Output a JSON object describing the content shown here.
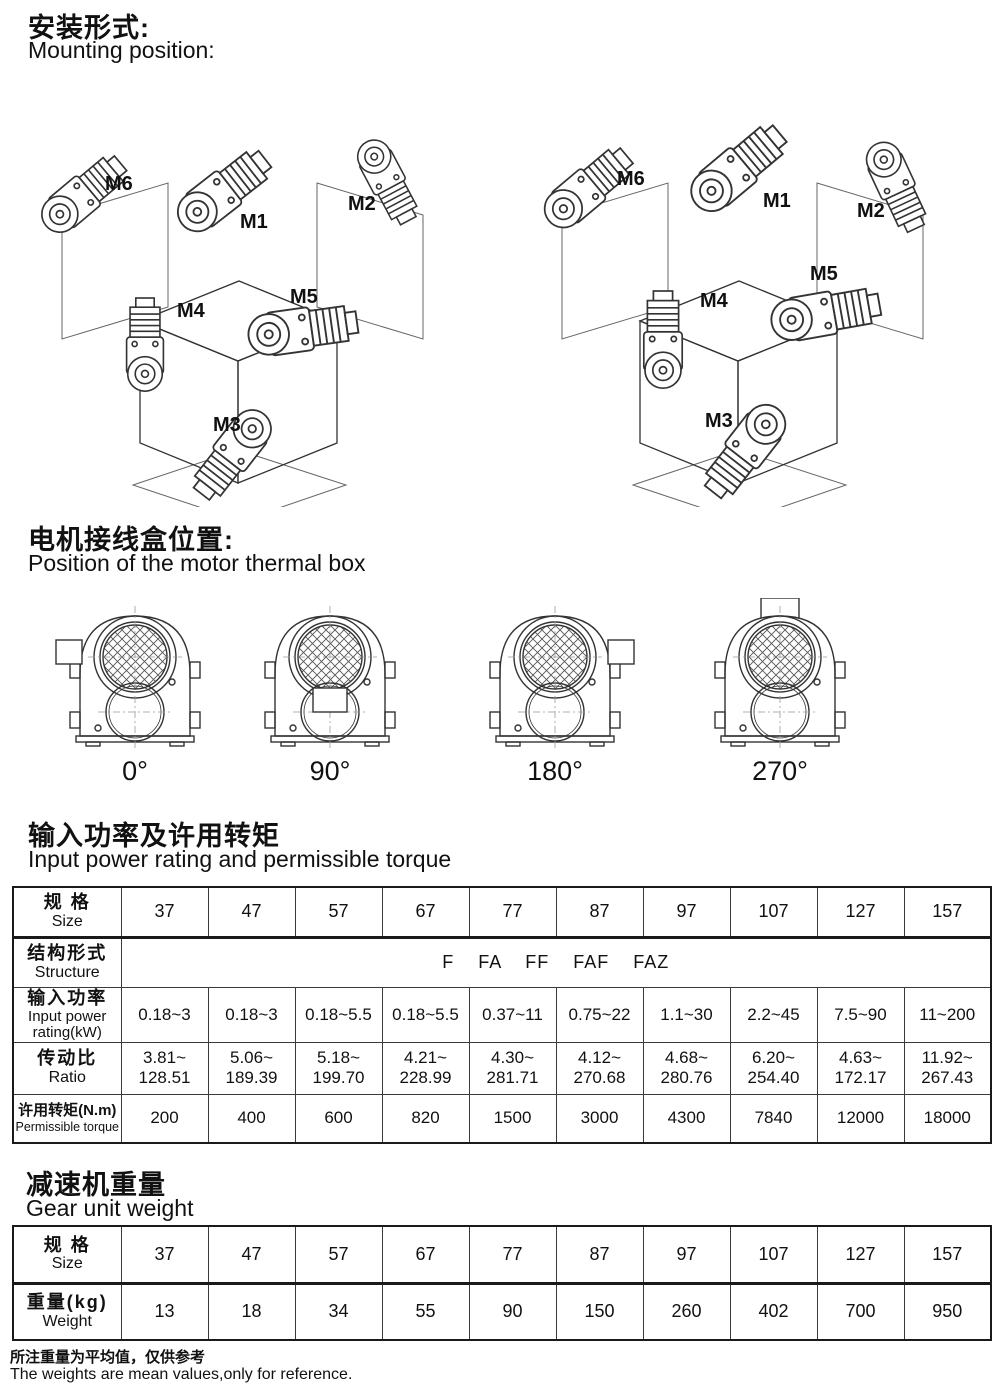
{
  "mounting": {
    "title_zh": "安装形式:",
    "title_en": "Mounting position:",
    "labels": {
      "m1": "M1",
      "m2": "M2",
      "m3": "M3",
      "m4": "M4",
      "m5": "M5",
      "m6": "M6"
    }
  },
  "thermal": {
    "title_zh": "电机接线盒位置:",
    "title_en": "Position of the motor thermal box",
    "angles": [
      "0°",
      "90°",
      "180°",
      "270°"
    ]
  },
  "power_table": {
    "title_zh": "输入功率及许用转矩",
    "title_en": "Input power rating and permissible torque",
    "head": {
      "zh": "规 格",
      "en": "Size"
    },
    "sizes": [
      "37",
      "47",
      "57",
      "67",
      "77",
      "87",
      "97",
      "107",
      "127",
      "157"
    ],
    "structure": {
      "zh": "结构形式",
      "en": "Structure",
      "value": "F    FA    FF    FAF    FAZ"
    },
    "power": {
      "zh": "输入功率",
      "en": "Input power",
      "en2": "rating(kW)",
      "values": [
        "0.18~3",
        "0.18~3",
        "0.18~5.5",
        "0.18~5.5",
        "0.37~11",
        "0.75~22",
        "1.1~30",
        "2.2~45",
        "7.5~90",
        "11~200"
      ]
    },
    "ratio": {
      "zh": "传动比",
      "en": "Ratio",
      "top": [
        "3.81~",
        "5.06~",
        "5.18~",
        "4.21~",
        "4.30~",
        "4.12~",
        "4.68~",
        "6.20~",
        "4.63~",
        "11.92~"
      ],
      "bottom": [
        "128.51",
        "189.39",
        "199.70",
        "228.99",
        "281.71",
        "270.68",
        "280.76",
        "254.40",
        "172.17",
        "267.43"
      ]
    },
    "torque": {
      "zh": "许用转矩(N.m)",
      "en": "Permissible torque",
      "values": [
        "200",
        "400",
        "600",
        "820",
        "1500",
        "3000",
        "4300",
        "7840",
        "12000",
        "18000"
      ]
    }
  },
  "weight_table": {
    "title_zh": "减速机重量",
    "title_en": "Gear unit weight",
    "head": {
      "zh": "规 格",
      "en": "Size"
    },
    "sizes": [
      "37",
      "47",
      "57",
      "67",
      "77",
      "87",
      "97",
      "107",
      "127",
      "157"
    ],
    "weight": {
      "zh": "重量(kg)",
      "en": "Weight",
      "values": [
        "13",
        "18",
        "34",
        "55",
        "90",
        "150",
        "260",
        "402",
        "700",
        "950"
      ]
    }
  },
  "footer": {
    "note_zh": "所注重量为平均值，仅供参考",
    "note_en": "The weights are mean values,only for reference."
  }
}
